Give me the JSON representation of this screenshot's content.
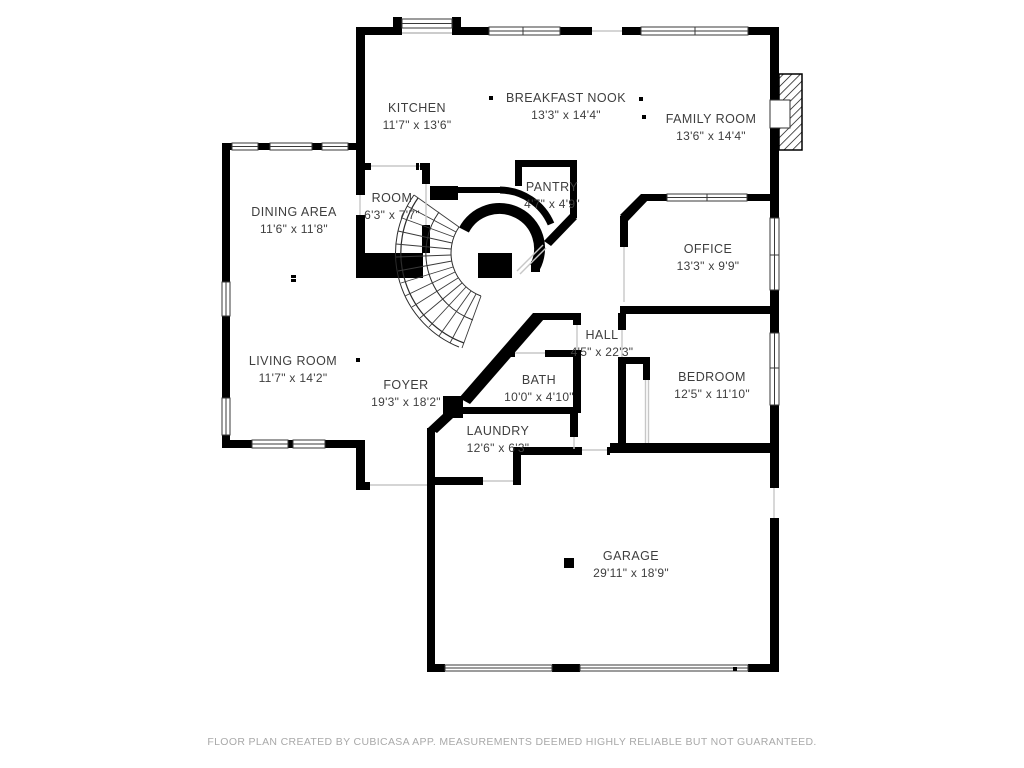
{
  "rooms": {
    "kitchen": {
      "name": "KITCHEN",
      "dims": "11'7\" x 13'6\""
    },
    "breakfast_nook": {
      "name": "BREAKFAST NOOK",
      "dims": "13'3\" x 14'4\""
    },
    "family_room": {
      "name": "FAMILY ROOM",
      "dims": "13'6\" x 14'4\""
    },
    "dining_area": {
      "name": "DINING AREA",
      "dims": "11'6\" x 11'8\""
    },
    "room": {
      "name": "ROOM",
      "dims": "6'3\" x 7'7\""
    },
    "pantry": {
      "name": "PANTRY",
      "dims": "4'7\" x 4'9\""
    },
    "office": {
      "name": "OFFICE",
      "dims": "13'3\" x 9'9\""
    },
    "hall": {
      "name": "HALL",
      "dims": "4'5\" x 22'3\""
    },
    "living_room": {
      "name": "LIVING ROOM",
      "dims": "11'7\" x 14'2\""
    },
    "foyer": {
      "name": "FOYER",
      "dims": "19'3\" x 18'2\""
    },
    "bath": {
      "name": "BATH",
      "dims": "10'0\" x 4'10\""
    },
    "bedroom": {
      "name": "BEDROOM",
      "dims": "12'5\" x 11'10\""
    },
    "laundry": {
      "name": "LAUNDRY",
      "dims": "12'6\" x 6'3\""
    },
    "garage": {
      "name": "GARAGE",
      "dims": "29'11\" x 18'9\""
    }
  },
  "footer": {
    "text": "FLOOR PLAN CREATED BY CUBICASA APP. MEASUREMENTS DEEMED HIGHLY RELIABLE BUT NOT GUARANTEED."
  },
  "colors": {
    "wall": "#000000",
    "label": "#3e3e3e",
    "footer_text": "#a9a9a9"
  }
}
